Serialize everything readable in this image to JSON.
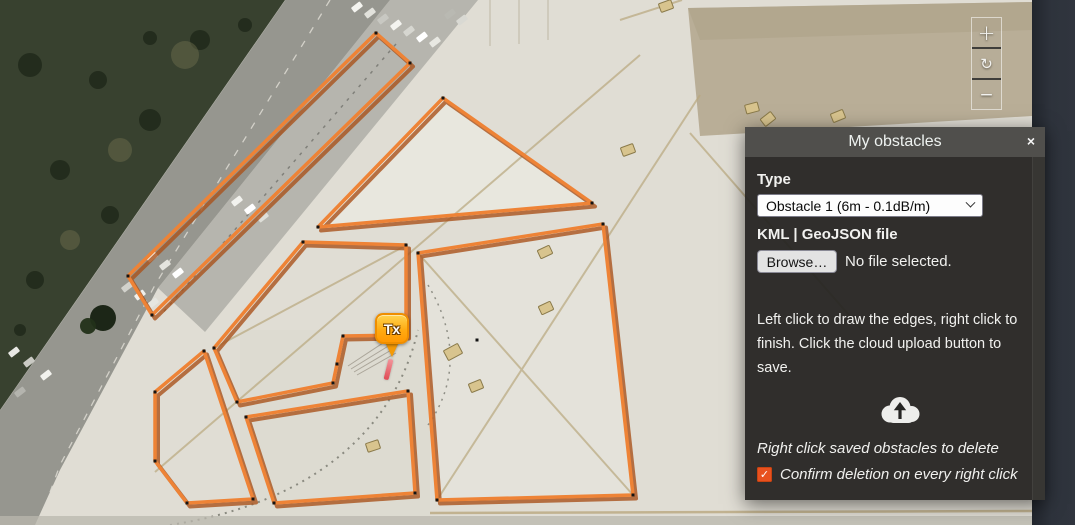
{
  "panel": {
    "title": "My obstacles",
    "close_glyph": "×",
    "type_label": "Type",
    "type_value": "Obstacle 1 (6m - 0.1dB/m)",
    "file_label": "KML | GeoJSON file",
    "browse_label": "Browse…",
    "no_file_text": "No file selected.",
    "instructions": "Left click to draw the edges, right click to finish. Click the cloud upload button to save.",
    "delete_hint": "Right click saved obstacles to delete",
    "confirm_label": "Confirm deletion on every right click",
    "confirm_checked": true,
    "check_glyph": "✓",
    "accent_color": "#e8511f"
  },
  "map": {
    "controls": [
      {
        "name": "zoom-in",
        "label": "+"
      },
      {
        "name": "reload",
        "label": "↻"
      },
      {
        "name": "zoom-out",
        "label": "−"
      }
    ],
    "marker": {
      "label": "Tx",
      "x": 392,
      "y": 358
    },
    "draw_segment": {
      "x": 386,
      "y": 359,
      "len": 21,
      "angle": 14
    },
    "obstacle_stroke": "#ee8336",
    "obstacle_shadow": "#a9521b",
    "vertex_color": "#141414",
    "polygons": [
      {
        "points": [
          [
            376,
            33
          ],
          [
            410,
            63
          ],
          [
            152,
            315
          ],
          [
            128,
            276
          ]
        ]
      },
      {
        "points": [
          [
            443,
            98
          ],
          [
            592,
            203
          ],
          [
            318,
            227
          ]
        ]
      },
      {
        "points": [
          [
            418,
            253
          ],
          [
            603,
            224
          ],
          [
            633,
            495
          ],
          [
            437,
            500
          ]
        ]
      },
      {
        "points": [
          [
            303,
            242
          ],
          [
            406,
            245
          ],
          [
            406,
            335
          ],
          [
            343,
            336
          ],
          [
            337,
            364
          ],
          [
            333,
            383
          ],
          [
            237,
            402
          ],
          [
            214,
            348
          ]
        ]
      },
      {
        "points": [
          [
            204,
            351
          ],
          [
            253,
            499
          ],
          [
            187,
            503
          ],
          [
            155,
            461
          ],
          [
            155,
            392
          ]
        ]
      },
      {
        "points": [
          [
            246,
            417
          ],
          [
            408,
            391
          ],
          [
            415,
            493
          ],
          [
            274,
            503
          ]
        ]
      }
    ],
    "stray_vertices": [
      [
        477,
        340
      ]
    ]
  }
}
